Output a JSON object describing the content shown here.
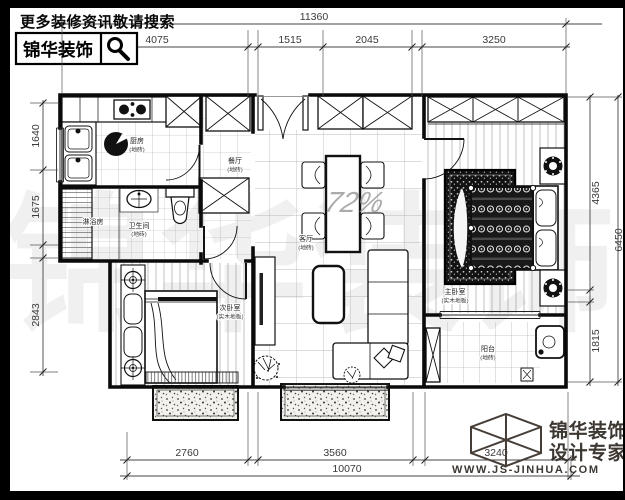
{
  "header": {
    "promo_text": "更多装修资讯敬请搜索",
    "brand": "锦华装饰"
  },
  "watermark": {
    "brand": "锦华装饰",
    "note": "72%"
  },
  "footer": {
    "brand_line1": "锦华装饰",
    "brand_line2": "设计专家",
    "website": "WWW.JS-JINHUA.COM",
    "logo_color": "#3d3732"
  },
  "dims": {
    "top": {
      "overall": "11360",
      "segments": [
        "4075",
        "1515",
        "2045",
        "3250"
      ]
    },
    "left": {
      "segments": [
        "1640",
        "1675",
        "2843"
      ]
    },
    "right": {
      "segments": [
        "4365",
        "1815"
      ],
      "overall": "6450"
    },
    "bottom": {
      "segments": [
        "2760",
        "3560",
        "3240"
      ],
      "overall": "10070"
    }
  },
  "rooms": {
    "kitchen": {
      "name": "厨房",
      "floor": "(地砖)"
    },
    "shower": {
      "name": "淋浴房"
    },
    "bath": {
      "name": "卫生间",
      "floor": "(地砖)"
    },
    "dining": {
      "name": "餐厅",
      "floor": "(地砖)"
    },
    "living": {
      "name": "客厅",
      "floor": "(地砖)"
    },
    "bedroom2": {
      "name": "次卧室",
      "floor": "(实木地板)"
    },
    "master": {
      "name": "主卧室",
      "floor": "(实木地板)"
    },
    "utility": {
      "name": "阳台",
      "floor": "(地砖)"
    }
  }
}
